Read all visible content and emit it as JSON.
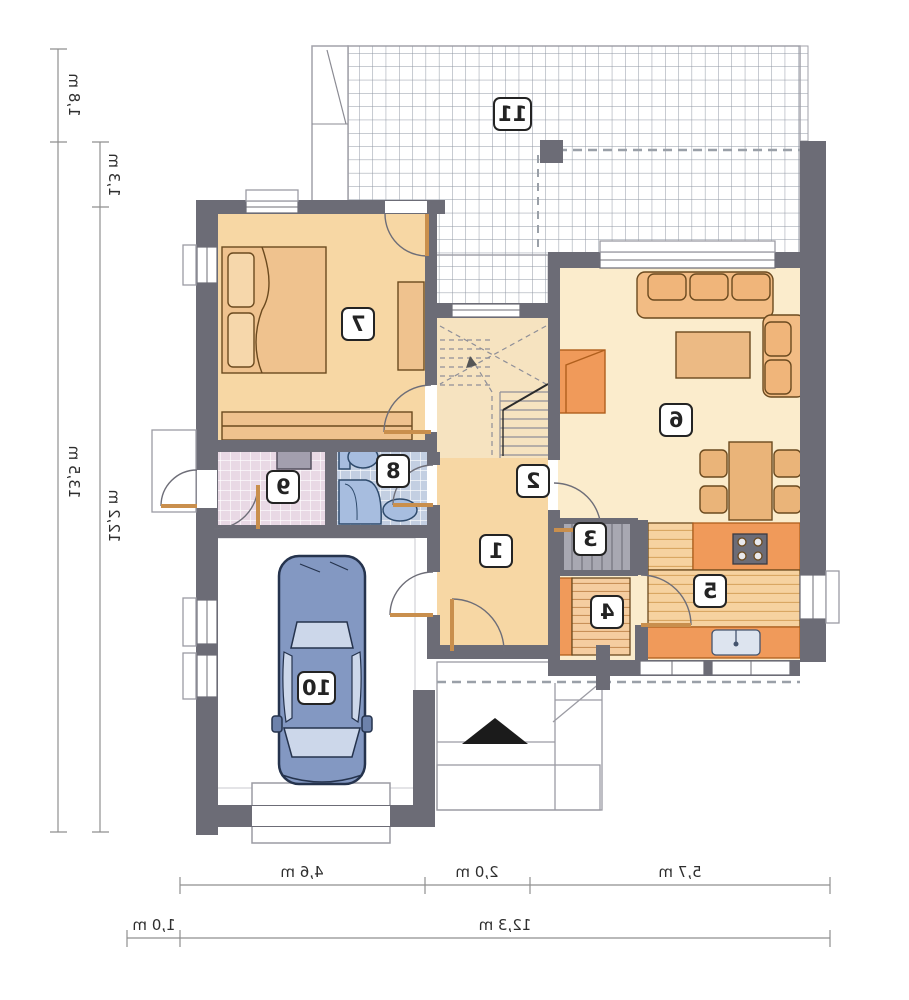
{
  "plan_title": "floor-plan",
  "rooms": [
    "1",
    "2",
    "3",
    "4",
    "5",
    "6",
    "7",
    "8",
    "9",
    "10",
    "11"
  ],
  "dims": [
    "1,8 m",
    "13,5 m",
    "1,3 m",
    "12,2 m",
    "4,6 m",
    "2,0 m",
    "5,7 m",
    "1,0 m",
    "12,3 m"
  ],
  "colors": {
    "wall": "#6c6c76",
    "floor_peach": "#f7d7a4",
    "floor_cream": "#fbeccc",
    "tile_bath": "#c3cfe2",
    "tile_utility": "#e9d9e5",
    "furniture_tan": "#efc28e",
    "furniture_orange": "#f09a5a",
    "fixture_blue": "#a7bddf",
    "car_blue": "#8398c2",
    "car_glass": "#ccd7ea"
  }
}
